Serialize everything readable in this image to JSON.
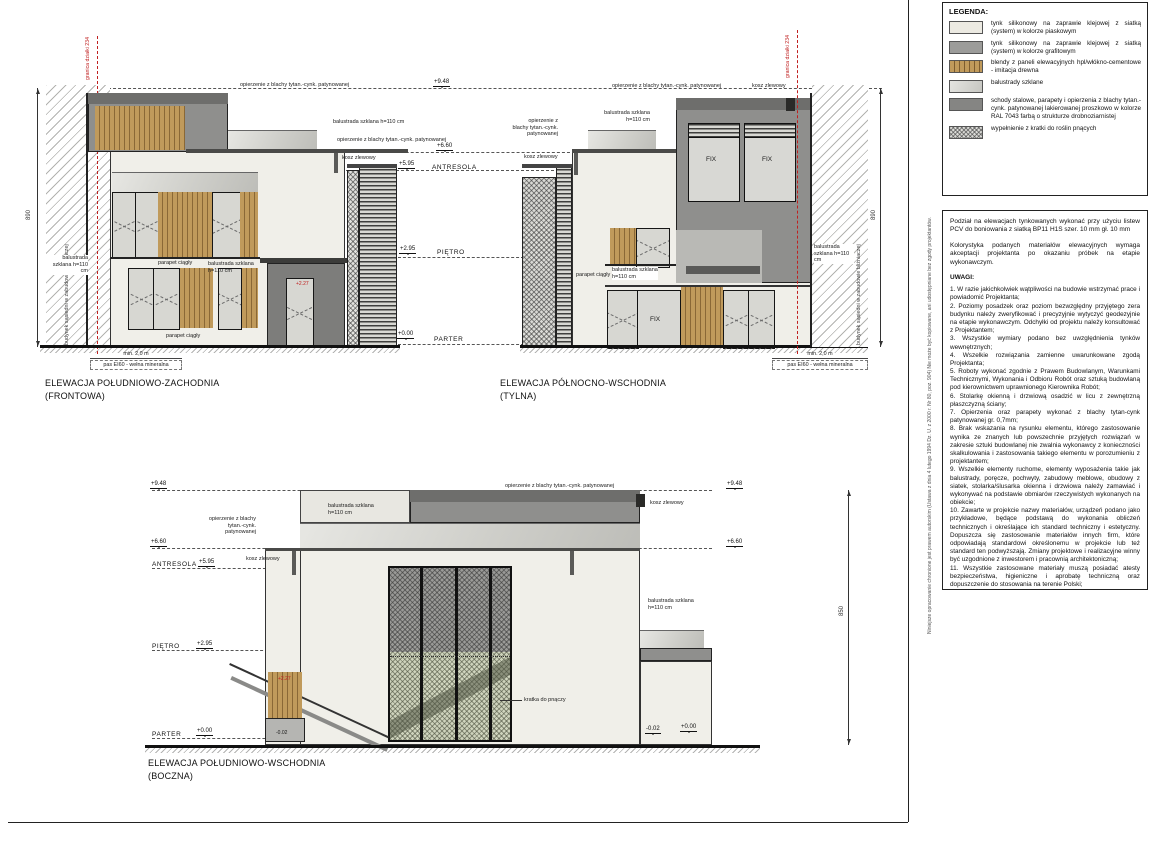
{
  "colors": {
    "boundary_red": "#c02020",
    "graphite": "#8f8f8d",
    "wood": "#c09a5b",
    "facade": "#f0efe9"
  },
  "legend": {
    "title": "LEGENDA:",
    "items": [
      {
        "swatch": "sand",
        "text": "tynk silikonowy na zaprawie klejowej z siatką (system) w kolorze piaskowym"
      },
      {
        "swatch": "graphite",
        "text": "tynk silikonowy na zaprawie klejowej z siatką (system) w kolorze grafitowym"
      },
      {
        "swatch": "wood",
        "text": "blendy z paneli elewacyjnych hpl/włókno-cementowe - imitacja drewna"
      },
      {
        "swatch": "glass",
        "text": "balustrady szklane"
      },
      {
        "swatch": "steel",
        "text": "schody stalowe, parapety i opierzenia z blachy tytan.-cynk. patynowanej lakierowanej proszkowo w kolorze RAL 7043 farbą o strukturze drobnoziarnistej"
      },
      {
        "swatch": "mesh",
        "text": "wypełnienie z kratki do roślin pnących"
      }
    ]
  },
  "notes": {
    "p1": "Podział na elewacjach tynkowanych wykonać przy użyciu listew PCV do boniowania z siatką BP11 H1S szer. 10 mm gł. 10 mm",
    "p2": "Kolorystyka podanych materiałów elewacyjnych wymaga akceptacji projektanta po okazaniu próbek na etapie wykonawczym.",
    "uwagi_title": "UWAGI:",
    "items": [
      "1. W razie jakichkolwiek wątpliwości na budowie wstrzymać prace i powiadomić Projektanta;",
      "2. Poziomy posadzek oraz poziom bezwzględny przyjętego zera budynku należy zweryfikować i precyzyjnie wytyczyć geodezyjnie na etapie wykonawczym. Odchyłki od projektu należy konsultować z Projektantem;",
      "3. Wszystkie wymiary podano bez uwzględnienia tynków wewnętrznych;",
      "4. Wszelkie rozwiązania zamienne uwarunkowane zgodą Projektanta;",
      "5. Roboty wykonać zgodnie z Prawem Budowlanym, Warunkami Technicznymi, Wykonania i Odbioru Robót oraz sztuką budowlaną pod kierownictwem uprawnionego Kierownika Robót;",
      "6. Stolarkę okienną i drzwiową osadzić w licu z zewnętrzną płaszczyzną ściany;",
      "7. Opierzenia oraz parapety wykonać z blachy tytan-cynk patynowanej gr. 0,7mm;",
      "8. Brak wskazania na rysunku elementu, którego zastosowanie wynika ze znanych lub powszechnie przyjętych rozwiązań w zakresie sztuki budowlanej nie zwalnia wykonawcy z konieczności skalkulowania i zastosowania takiego elementu w porozumieniu z projektantem;",
      "9. Wszelkie elementy ruchome, elementy wyposażenia takie jak balustrady, poręcze, pochwyty, zabudowy meblowe, obudowy z siatek, stolarka/ślusarka okienna i drzwiowa należy zamawiać i wykonywać na podstawie obmiarów rzeczywistych wykonanych na obiekcie;",
      "10. Zawarte w projekcie nazwy materiałów, urządzeń podano jako przykładowe, będące podstawą do wykonania obliczeń technicznych i określające ich standard techniczny i estetyczny. Dopuszcza się zastosowanie materiałów innych firm, które odpowiadają standardowi określonemu w projekcie lub też standard ten podwyższają. Zmiany projektowe i realizacyjne winny być uzgodnione z inwestorem i pracownią architektoniczną;",
      "11. Wszystkie zastosowane materiały muszą posiadać atesty bezpieczeństwa, higieniczne i aprobatę techniczną oraz dopuszczenie do stosowania na terenie Polski;",
      "12. Szczegóły wykończenia wewnętrznego: posadzek, ścian, sufitów, obudowy, cokoły, balustrady, drzwi wg projektu wnętrz."
    ]
  },
  "copyright": "Niniejsze opracowanie chronione jest prawem autorskim (Ustawa z dnia 4 lutego 1994 Dz. U. z 2000 r. Nr 80, poz. 904) Nie może być kopiowane, ani udostępniane bez zgody projektantów.",
  "elevations": {
    "front": {
      "l1": "ELEWACJA POŁUDNIOWO-ZACHODNIA",
      "l2": "(FRONTOWA)"
    },
    "rear": {
      "l1": "ELEWACJA PÓŁNOCNO-WSCHODNIA",
      "l2": "(TYLNA)"
    },
    "side": {
      "l1": "ELEWACJA POŁUDNIOWO-WSCHODNIA",
      "l2": "(BOCZNA)"
    }
  },
  "levels": {
    "p948": "+9.48",
    "p660": "+6.60",
    "p595": "+5.95",
    "p295": "+2.95",
    "p000": "+0.00",
    "p227": "+2.27",
    "m002": "-0.02",
    "antresola": "ANTRESOLA",
    "pietro": "PIĘTRO",
    "parter": "PARTER"
  },
  "ann": {
    "opierzenie": "opierzenie z blachy tytan.-cynk. patynowanej",
    "balustrada": "balustrada szklana h=110 cm",
    "kosz": "kosz zlewowy",
    "parapet": "parapet ciągły",
    "kratka": "kratka do pnączy",
    "fix": "FIX",
    "granica": "granica działki 234",
    "sasiedni": "budynek sąsiedni w zabudowie bliźniaczej",
    "min20": "min. 2,0 m",
    "pas": "pas EI60 - wełna mineralna",
    "dim890": "890",
    "dim850": "850"
  }
}
